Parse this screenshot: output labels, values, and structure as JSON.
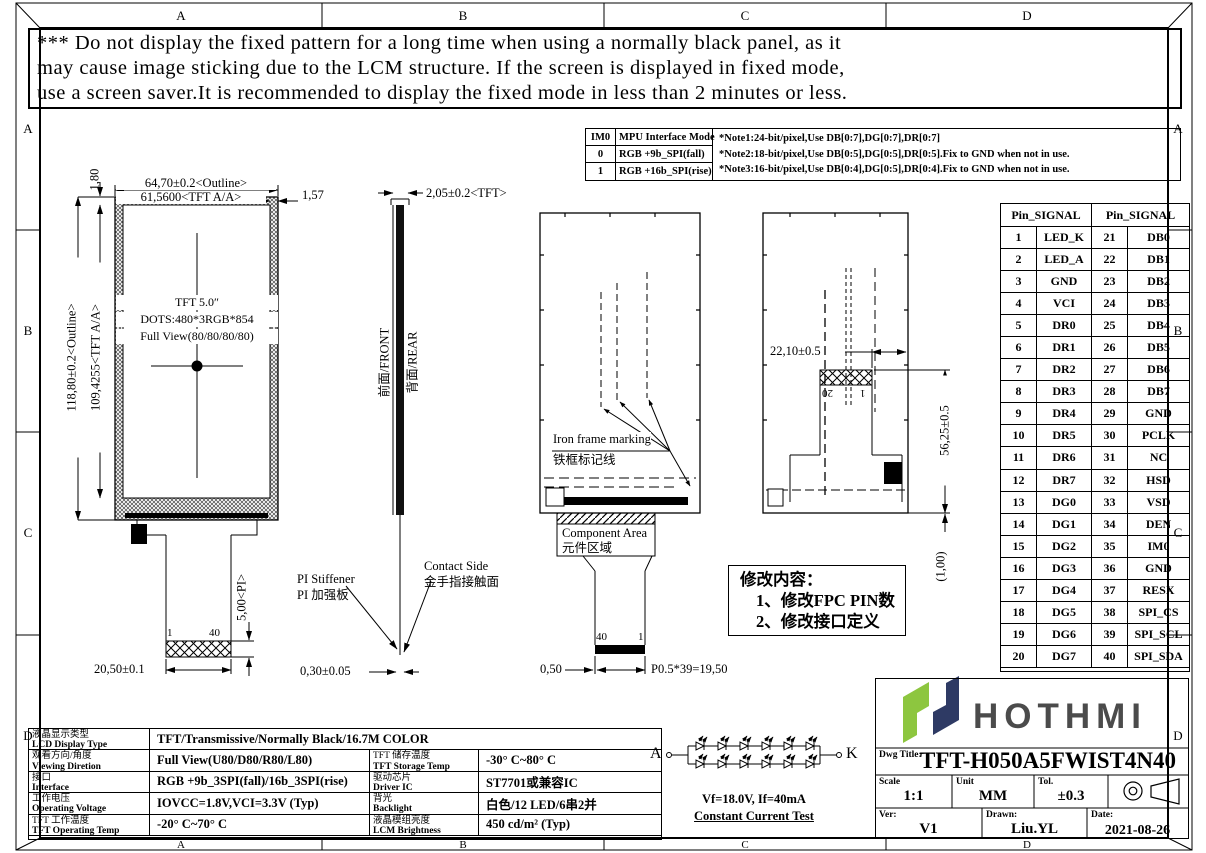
{
  "sheet": {
    "zones": [
      "A",
      "B",
      "C",
      "D"
    ]
  },
  "warning": {
    "lines": [
      "*** Do not display the fixed pattern for a long time when using a normally black panel, as it",
      "may cause image sticking due to the LCM structure. If the screen is displayed in fixed mode,",
      "use a screen saver.It is recommended to display the fixed mode in less than 2 minutes or less."
    ]
  },
  "interface_table": {
    "col1_header": "IM0",
    "col2_header": "MPU Interface Mode",
    "rows": [
      {
        "im0": "0",
        "mode": "RGB +9b_SPI(fall)"
      },
      {
        "im0": "1",
        "mode": "RGB +16b_SPI(rise)"
      }
    ],
    "notes": [
      "*Note1:24-bit/pixel,Use DB[0:7],DG[0:7],DR[0:7]",
      "*Note2:18-bit/pixel,Use DB[0:5],DG[0:5],DR[0:5].Fix to GND  when not in use.",
      "*Note3:16-bit/pixel,Use DB[0:4],DG[0:5],DR[0:4].Fix to GND  when not in use."
    ]
  },
  "front_view": {
    "title_lines": [
      "TFT 5.0″",
      "DOTS:480*3RGB*854",
      "Full View(80/80/80/80)"
    ],
    "dim_outline_w": "64,70±0.2<Outline>",
    "dim_aa_w": "61,5600<TFT A/A>",
    "dim_side_gap": "1,57",
    "dim_top_gap": "1,80",
    "dim_outline_h": "118,80±0.2<Outline>",
    "dim_aa_h": "109,4255<TFT A/A>",
    "dim_pi": "5,00<PI>",
    "dim_tail_w": "20,50±0.1",
    "pin_first": "1",
    "pin_last": "40"
  },
  "side_view": {
    "dim_thickness": "2,05±0.2<TFT>",
    "front_label": "前面/FRONT",
    "rear_label": "背面/REAR",
    "stiffener_en": "PI Stiffener",
    "stiffener_zh": "PI 加强板",
    "contact_en": "Contact Side",
    "contact_zh": "金手指接触面",
    "dim_pi_thickness": "0,30±0.05"
  },
  "rear_view_left": {
    "marking_en": "Iron frame marking",
    "marking_zh": "铁框标记线",
    "component_en": "Component Area",
    "component_zh": "元件区域",
    "pin_left": "40",
    "pin_right": "1",
    "dim_edge": "0,50",
    "dim_pitch": "P0.5*39=19,50"
  },
  "rear_view_right": {
    "dim_offset": "22,10±0.5",
    "dim_height": "56,25±0.5",
    "dim_thickness": "(1,00)",
    "pin_left": "20",
    "pin_right": "1"
  },
  "revision_box": {
    "title": "修改内容：",
    "items": [
      "1、修改FPC PIN数",
      "2、修改接口定义"
    ]
  },
  "pin_table": {
    "header": "Pin_SIGNAL",
    "rows": [
      [
        "1",
        "LED_K",
        "21",
        "DB0"
      ],
      [
        "2",
        "LED_A",
        "22",
        "DB1"
      ],
      [
        "3",
        "GND",
        "23",
        "DB2"
      ],
      [
        "4",
        "VCI",
        "24",
        "DB3"
      ],
      [
        "5",
        "DR0",
        "25",
        "DB4"
      ],
      [
        "6",
        "DR1",
        "26",
        "DB5"
      ],
      [
        "7",
        "DR2",
        "27",
        "DB6"
      ],
      [
        "8",
        "DR3",
        "28",
        "DB7"
      ],
      [
        "9",
        "DR4",
        "29",
        "GND"
      ],
      [
        "10",
        "DR5",
        "30",
        "PCLK"
      ],
      [
        "11",
        "DR6",
        "31",
        "NC"
      ],
      [
        "12",
        "DR7",
        "32",
        "HSD"
      ],
      [
        "13",
        "DG0",
        "33",
        "VSD"
      ],
      [
        "14",
        "DG1",
        "34",
        "DEN"
      ],
      [
        "15",
        "DG2",
        "35",
        "IM0"
      ],
      [
        "16",
        "DG3",
        "36",
        "GND"
      ],
      [
        "17",
        "DG4",
        "37",
        "RESX"
      ],
      [
        "18",
        "DG5",
        "38",
        "SPI_CS"
      ],
      [
        "19",
        "DG6",
        "39",
        "SPI_SCL"
      ],
      [
        "20",
        "DG7",
        "40",
        "SPI_SDA"
      ]
    ]
  },
  "spec_table": {
    "rows": [
      {
        "label_zh": "液晶显示类型",
        "label_en": "LCD Display Type",
        "value": "TFT/Transmissive/Normally Black/16.7M COLOR",
        "span": true
      },
      {
        "label_zh": "观看方向/角度",
        "label_en": "Viewing Diretion",
        "value": "Full View(U80/D80/R80/L80)",
        "label2_zh": "TFT 储存温度",
        "label2_en": "TFT Storage Temp",
        "value2": "-30° C~80° C"
      },
      {
        "label_zh": "接口",
        "label_en": "Interface",
        "value": "RGB +9b_3SPI(fall)/16b_3SPI(rise)",
        "label2_zh": "驱动芯片",
        "label2_en": "Driver IC",
        "value2": "ST7701或兼容IC"
      },
      {
        "label_zh": "工作电压",
        "label_en": "Operating Voltage",
        "value": "IOVCC=1.8V,VCI=3.3V (Typ)",
        "label2_zh": "背光",
        "label2_en": "Backlight",
        "value2": "白色/12 LED/6串2并"
      },
      {
        "label_zh": "TFT 工作温度",
        "label_en": "TFT Operating Temp",
        "value": "-20° C~70° C",
        "label2_zh": "液晶模组亮度",
        "label2_en": "LCM Brightness",
        "value2": "450 cd/m² (Typ)"
      }
    ]
  },
  "led_circuit": {
    "anode_label": "A",
    "cathode_label": "K",
    "spec": "Vf=18.0V, If=40mA",
    "test_label": "Constant Current Test",
    "rows": 2,
    "leds_per_row": 6
  },
  "title_block": {
    "logo_text": "HOTHMI",
    "dwg_title_label": "Dwg Title:",
    "dwg_title": "TFT-H050A5FWIST4N40",
    "scale_label": "Scale",
    "scale": "1:1",
    "unit_label": "Unit",
    "unit": "MM",
    "tol_label": "Tol.",
    "tol": "±0.3",
    "ver_label": "Ver:",
    "ver": "V1",
    "drawn_label": "Drawn:",
    "drawn": "Liu.YL",
    "date_label": "Date:",
    "date": "2021-08-26"
  },
  "colors": {
    "line": "#000000",
    "logo_green": "#8dc63f",
    "logo_navy": "#2e3a64",
    "logo_text": "#4b4b4b"
  }
}
